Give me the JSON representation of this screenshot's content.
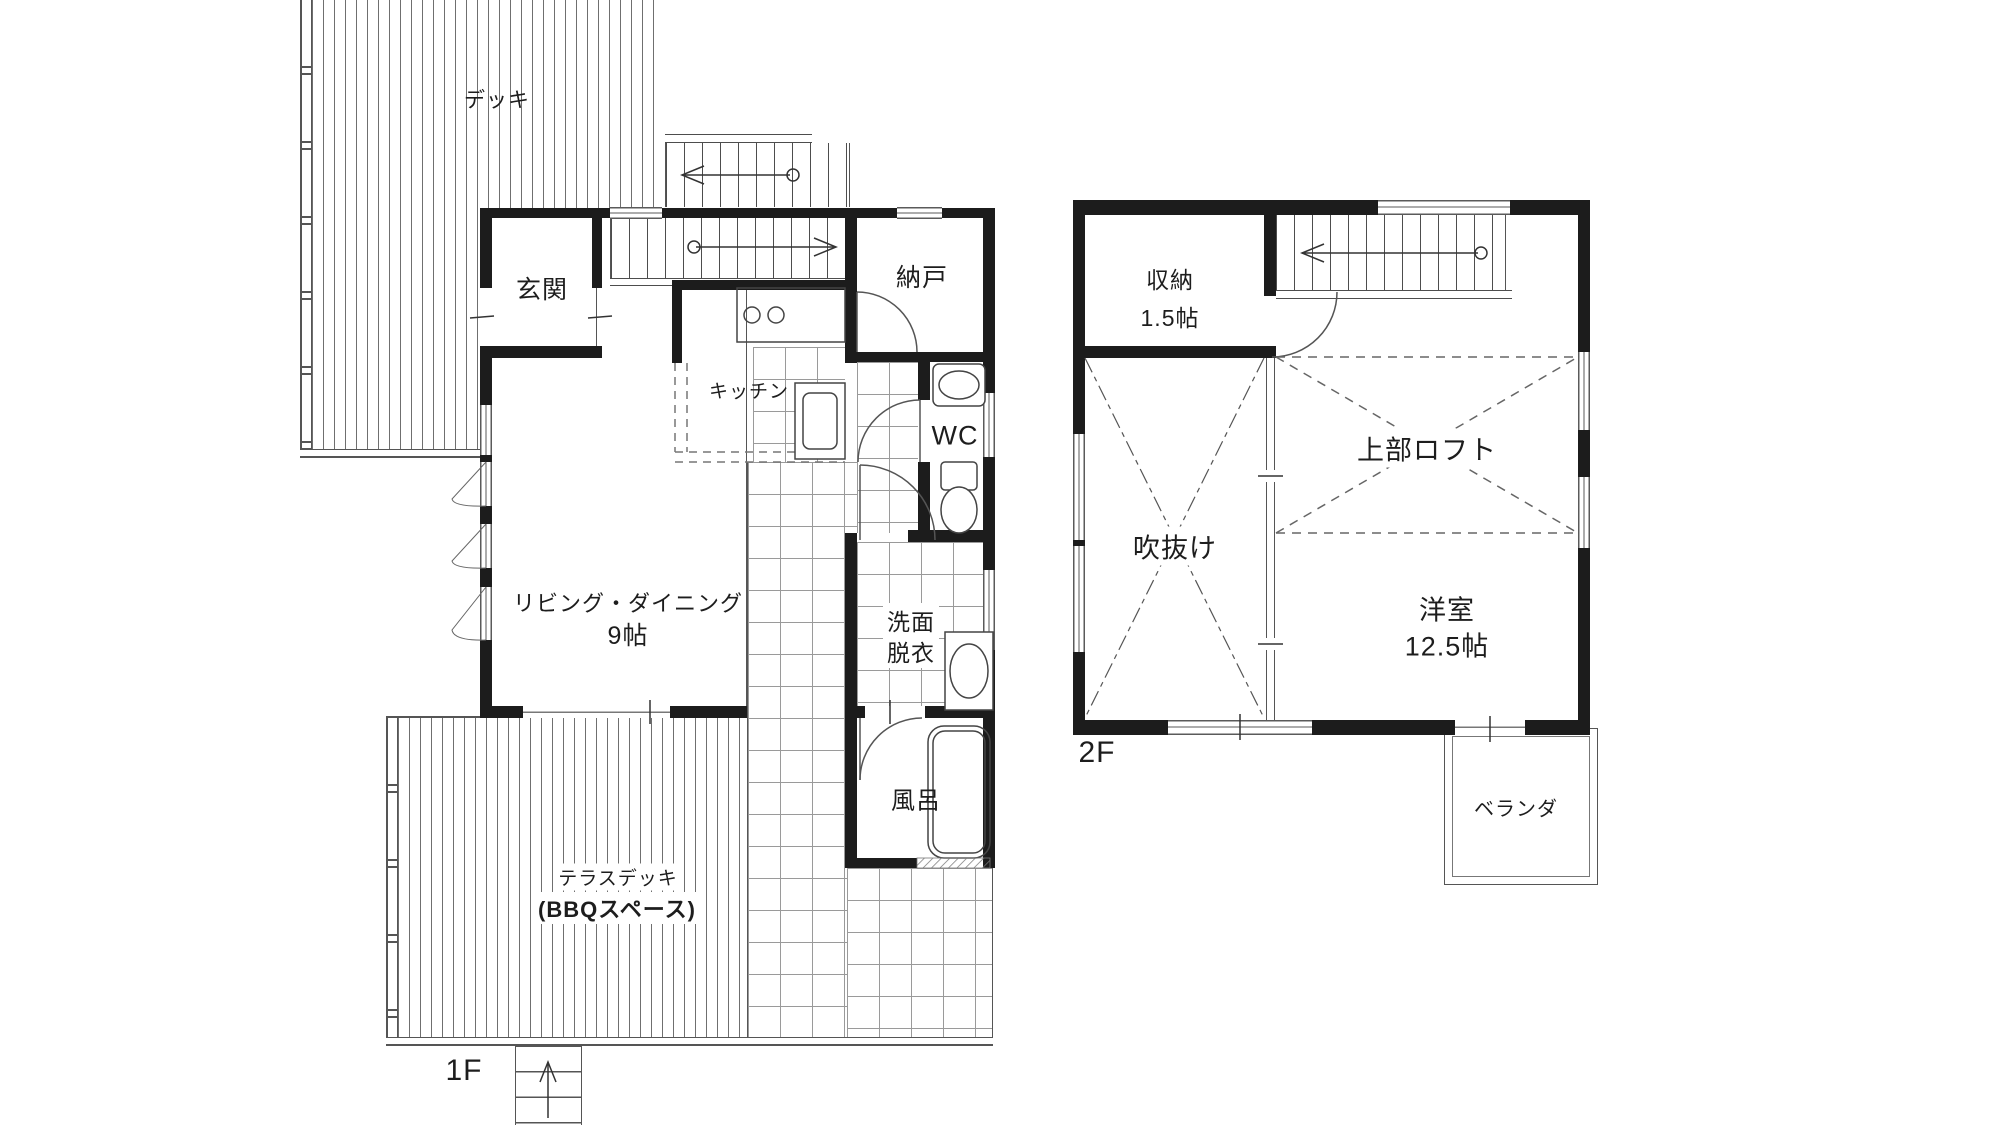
{
  "plan": {
    "f1": {
      "floor_label": "1F",
      "deck": "デッキ",
      "entrance": "玄関",
      "storage_room": "納戸",
      "kitchen": "キッチン",
      "wc": "WC",
      "living_dining": "リビング・ダイニング",
      "living_dining_size": "9帖",
      "washroom_line1": "洗面",
      "washroom_line2": "脱衣",
      "bath": "風呂",
      "terrace_line1": "テラスデッキ",
      "terrace_line2": "(BBQスペース)"
    },
    "f2": {
      "floor_label": "2F",
      "closet": "収納",
      "closet_size": "1.5帖",
      "loft": "上部ロフト",
      "void": "吹抜け",
      "bedroom": "洋室",
      "bedroom_size": "12.5帖",
      "veranda": "ベランダ"
    }
  },
  "colors": {
    "wall": "#1c1c1c",
    "line": "#555555",
    "grid": "#9a9a9a",
    "dash": "#777777",
    "background": "#ffffff"
  }
}
